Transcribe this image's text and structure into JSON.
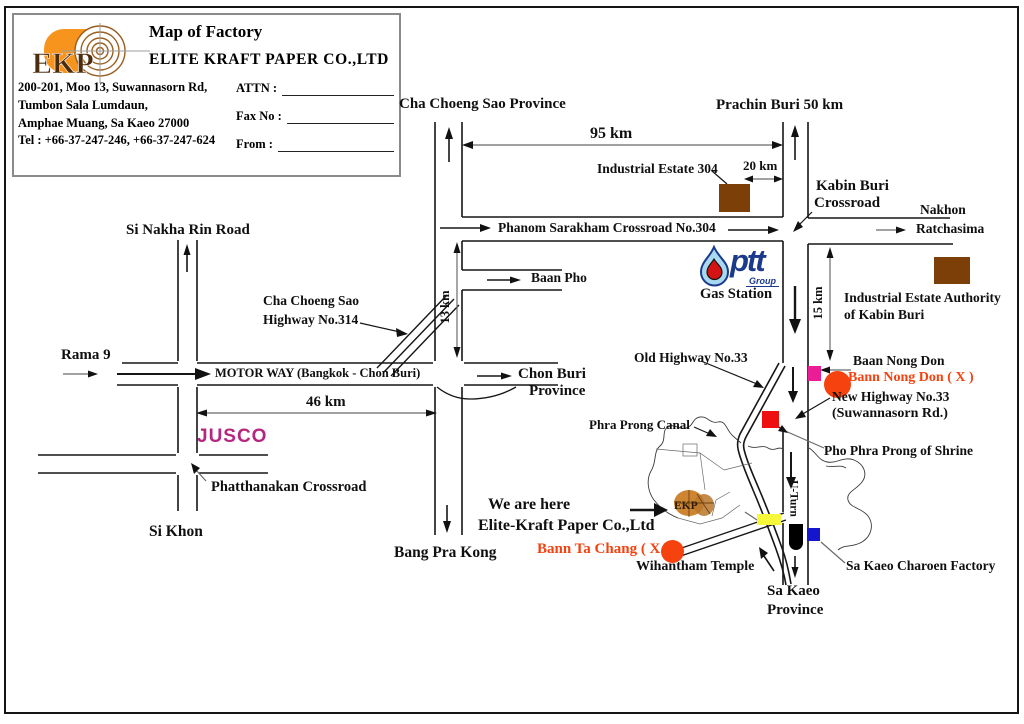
{
  "header": {
    "logo_text": "EKP",
    "title": "Map of Factory",
    "company": "ELITE KRAFT PAPER CO.,LTD",
    "address_lines": [
      "200-201, Moo 13, Suwannasorn Rd,",
      "Tumbon Sala Lumdaun,",
      "Amphae Muang,  Sa Kaeo 27000",
      "Tel : +66-37-247-246, +66-37-247-624"
    ],
    "form": {
      "attn_label": "ATTN :",
      "fax_label": "Fax No :",
      "from_label": "From  :"
    }
  },
  "labels": {
    "cha_choeng_sao_province": "Cha Choeng Sao Province",
    "prachin_buri": "Prachin Buri 50 km",
    "km95": "95 km",
    "industrial_estate_304": "Industrial Estate 304",
    "km20": "20 km",
    "kabin_buri_line1": "Kabin Buri",
    "kabin_buri_line2": "Crossroad",
    "nakhon_line1": "Nakhon",
    "nakhon_line2": "Ratchasima",
    "phanom_sarakham": "Phanom Sarakham  Crossroad No.304",
    "baan_pho": "Baan Pho",
    "km13": "13 km",
    "cha_choeng_hwy_line1": "Cha Choeng Sao",
    "cha_choeng_hwy_line2": "Highway No.314",
    "si_nakha_rin": "Si Nakha Rin Road",
    "rama9": "Rama 9",
    "motorway": "MOTOR WAY (Bangkok - Chon Buri)",
    "chon_buri_line1": "Chon Buri",
    "chon_buri_line2": "Province",
    "km46": "46 km",
    "jusco": "JUSCO",
    "phatthanakan": "Phatthanakan Crossroad",
    "si_khon": "Si Khon",
    "bang_pra_kong": "Bang Pra Kong",
    "ptt": "ptt",
    "ptt_group": "Group",
    "gas_station": "Gas Station",
    "old_highway": "Old Highway No.33",
    "baan_nong_don": "Baan Nong Don",
    "bann_nong_don_x": "Bann Nong Don ( X )",
    "new_highway_line1": "New Highway No.33",
    "new_highway_line2": "(Suwannasorn Rd.)",
    "km15": "15 km",
    "industrial_estate_authority_line1": "Industrial Estate Authority",
    "industrial_estate_authority_line2": "of Kabin Buri",
    "phra_prong_canal": "Phra Prong Canal",
    "pho_phra_prong": "Pho Phra Prong of Shrine",
    "u_turn": "U-Turn",
    "we_are_here_line1": "We are here",
    "we_are_here_line2": "Elite-Kraft Paper Co.,Ltd",
    "bann_ta_chang_x": "Bann Ta Chang ( X )",
    "wihantham": "Wihantham Temple",
    "sa_kaeo_line1": "Sa Kaeo",
    "sa_kaeo_line2": "Province",
    "sa_kaeo_charoen": "Sa Kaeo Charoen Factory",
    "ekp_site": "EKP"
  },
  "markers": {
    "industrial_estate_304": {
      "shape": "square",
      "color": "#7b3f07"
    },
    "industrial_estate_authority": {
      "shape": "square",
      "color": "#7b3f07"
    },
    "baan_nong_don": {
      "shape": "square",
      "color": "#ea1c96"
    },
    "bann_nong_don_x": {
      "shape": "circle",
      "color": "#f5420e"
    },
    "pho_phra_prong_shrine": {
      "shape": "square",
      "color": "#ee1010"
    },
    "bann_ta_chang_x": {
      "shape": "circle",
      "color": "#f5420e"
    },
    "wihantham_temple": {
      "shape": "rect",
      "color": "#f8f83a"
    },
    "sa_kaeo_charoen_factory": {
      "shape": "square",
      "color": "#1515ce"
    },
    "u_turn_bulb": {
      "shape": "bullet",
      "color": "#000000"
    },
    "ekp_factory_site": {
      "shape": "blob",
      "color": "#cd8532"
    }
  },
  "colors": {
    "road": "#161616",
    "brown": "#7b3f07",
    "pink": "#ea1c96",
    "red": "#ee1010",
    "orange_red": "#f5420e",
    "yellow": "#f8f83a",
    "blue": "#1515ce",
    "jusco_magenta": "#b5267e",
    "ptt_blue": "#1b3a8c",
    "ekp_orange": "#f7941e",
    "ekp_brown": "#4d2c0d"
  }
}
